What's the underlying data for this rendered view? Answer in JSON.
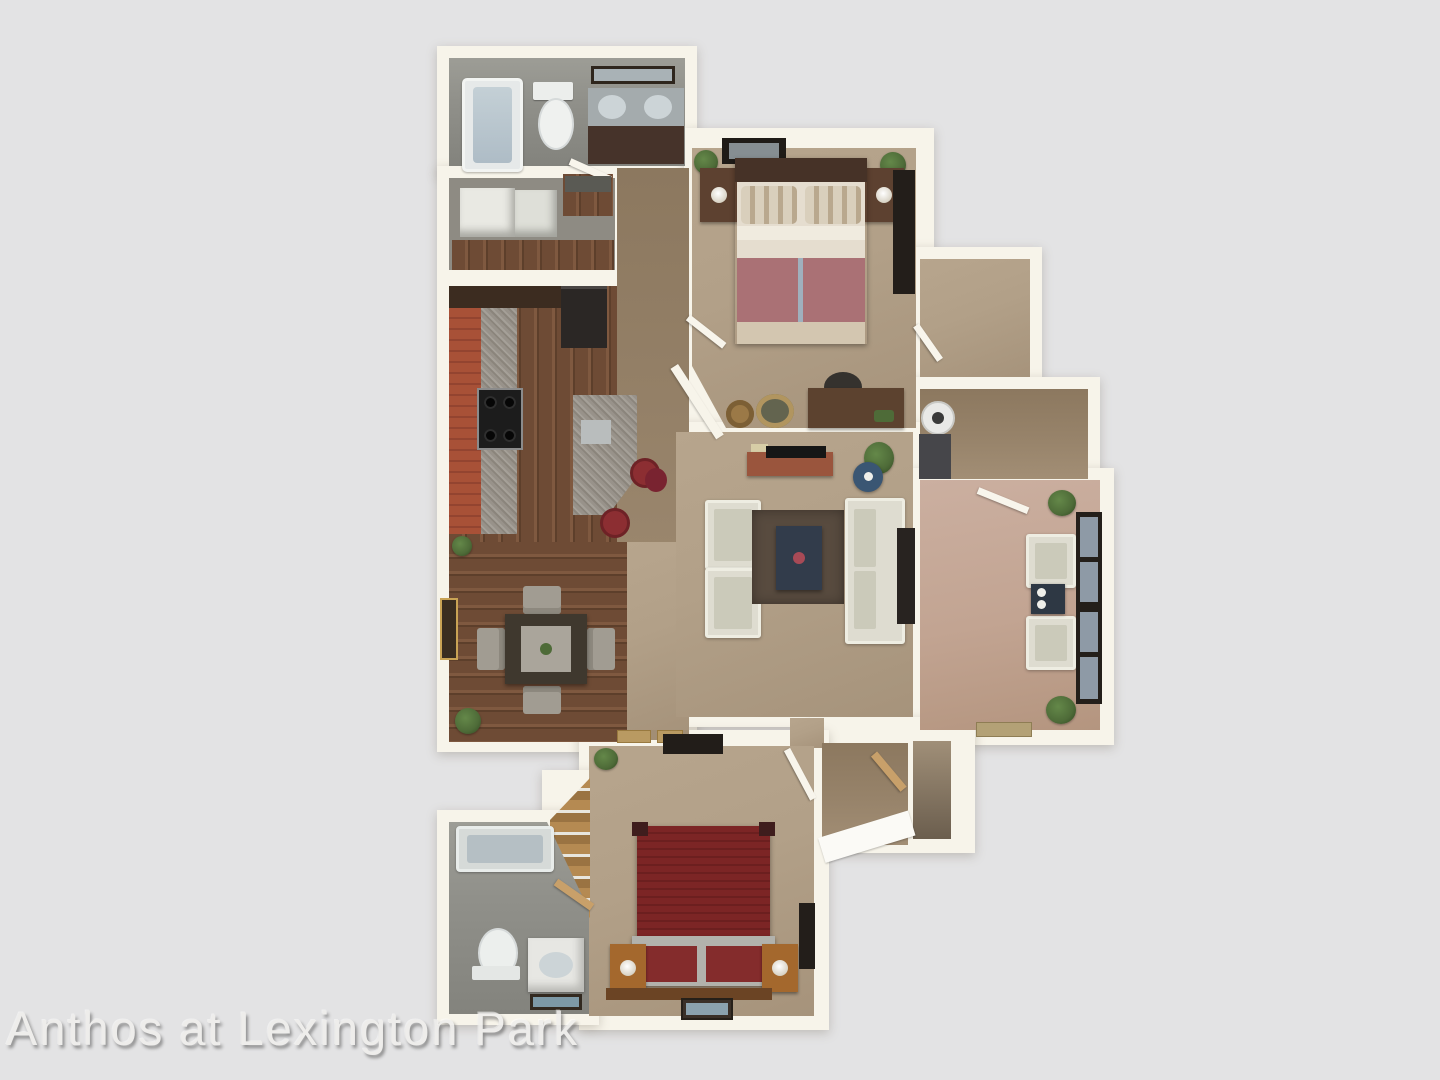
{
  "image": {
    "type": "3d-apartment-floor-plan-rendering",
    "width_px": 1440,
    "height_px": 1080
  },
  "watermark": {
    "text": "Anthos at Lexington Park"
  },
  "property": {
    "name": "Anthos at Lexington Park"
  },
  "rooms": [
    {
      "id": "bathroom-1",
      "label": "Master Bathroom",
      "features": [
        "bathtub",
        "toilet",
        "double-vanity",
        "mirror"
      ]
    },
    {
      "id": "walk-in-closet-1",
      "label": "Walk-in Closet",
      "features": [
        "shelving-units"
      ]
    },
    {
      "id": "pantry",
      "label": "Pantry Nook",
      "features": []
    },
    {
      "id": "hallway",
      "label": "Hallway",
      "features": []
    },
    {
      "id": "kitchen",
      "label": "Kitchen",
      "features": [
        "counter",
        "stove",
        "refrigerator",
        "peninsula",
        "bar-stools"
      ]
    },
    {
      "id": "dining",
      "label": "Dining Area",
      "features": [
        "dining-table",
        "four-chairs",
        "plants"
      ]
    },
    {
      "id": "bedroom-1",
      "label": "Bedroom 1",
      "features": [
        "queen-bed",
        "nightstands",
        "tv",
        "dresser",
        "desk",
        "baskets"
      ]
    },
    {
      "id": "closet-2",
      "label": "Walk-in Closet",
      "features": []
    },
    {
      "id": "laundry",
      "label": "Laundry",
      "features": [
        "washer",
        "dryer"
      ]
    },
    {
      "id": "living",
      "label": "Living Room",
      "features": [
        "sofa",
        "two-armchairs",
        "rug",
        "coffee-table",
        "media-console",
        "side-table"
      ]
    },
    {
      "id": "patio",
      "label": "Sunroom / Patio",
      "features": [
        "two-chairs",
        "side-table",
        "window-wall",
        "plants",
        "doormat"
      ]
    },
    {
      "id": "entry-hall",
      "label": "Entry Hall",
      "features": [
        "coat-closet"
      ]
    },
    {
      "id": "bedroom-2",
      "label": "Bedroom 2",
      "features": [
        "bed",
        "nightstands",
        "tv",
        "dresser",
        "closet"
      ]
    },
    {
      "id": "bathroom-2",
      "label": "Bathroom 2",
      "features": [
        "bathtub",
        "toilet",
        "vanity",
        "mat"
      ]
    }
  ],
  "palette": {
    "bg": "#e3e3e4",
    "wall": "#f7f4ea",
    "carpet": "#b2a088",
    "carpet_dark": "#97836a",
    "wood": "#6e4b35",
    "wood_light": "#7f5940",
    "bath_floor": "#90908a",
    "brick": "#a85137",
    "granite": "#98928a",
    "patio_floor": "#c2a492",
    "cream": "#dedcd0",
    "rug": "#584b3f",
    "navy": "#323c4b",
    "bed_red": "#7c2525",
    "mauve": "#aa7175",
    "dark": "#231e1a",
    "green": "#4e6b38",
    "oak": "#a4682d",
    "glass": "#8e9aa6",
    "watermark": "#f0efed"
  }
}
